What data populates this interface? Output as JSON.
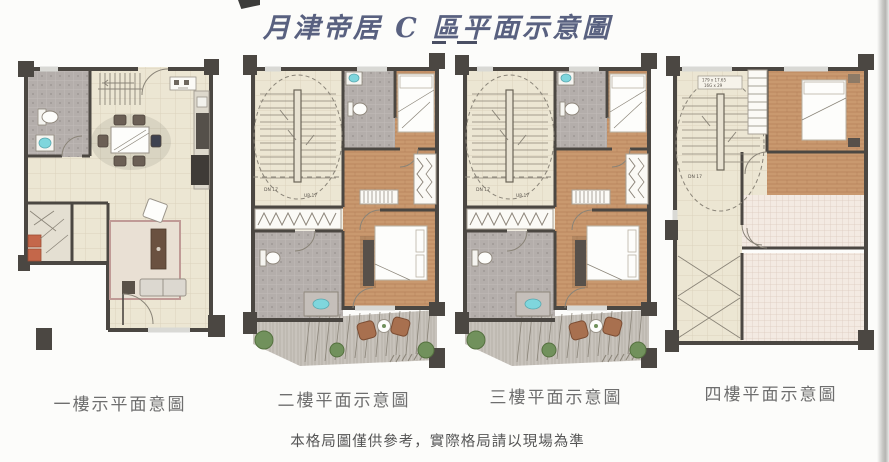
{
  "page": {
    "title": "月津帝居 C 區平面示意圖",
    "disclaimer": "本格局圖僅供參考，實際格局請以現場為準"
  },
  "plans": [
    {
      "id": "floor-1",
      "label": "一樓示平面意圖"
    },
    {
      "id": "floor-2",
      "label": "二樓平面示意圖",
      "stair_down": "DN 17",
      "stair_up": "UP 17"
    },
    {
      "id": "floor-3",
      "label": "三樓平面示意圖",
      "stair_down": "DN 17",
      "stair_up": "UP 17"
    },
    {
      "id": "floor-4",
      "label": "四樓平面示意圖",
      "stair_down": "DN 17",
      "stair_dim_line1": "179 x 17.65",
      "stair_dim_line2": "16G x 29"
    }
  ],
  "colors": {
    "title_ink": "#596180",
    "wall": "#4b4742",
    "tile_floor": "#ece6d3",
    "wood_floor": "#c9996f",
    "bath_gray": "#b4aeab",
    "deck_gray": "#c8c3bc",
    "terrace_pink": "#f3eae2",
    "sink_cyan": "#7fd6dd",
    "bush_green": "#71915c",
    "chair_brown": "#a8704f",
    "cabinet_orange": "#c4674a"
  }
}
